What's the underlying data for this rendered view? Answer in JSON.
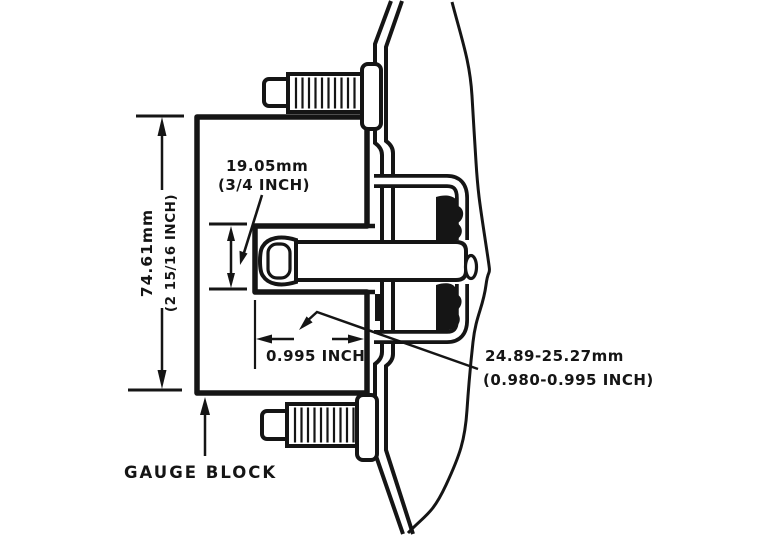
{
  "diagram": {
    "type": "technical-cross-section",
    "subject": "gauge block positioned against spindle and hub assembly",
    "colors": {
      "ink": "#151515",
      "background": "#ffffff"
    }
  },
  "dimensions": {
    "block_height_mm": "74.61mm",
    "block_height_in": "(2 15/16 INCH)",
    "notch_mm": "19.05mm",
    "notch_in": "(3/4 INCH)",
    "gap_in": "0.995 INCH",
    "bearing_mm": "24.89-25.27mm",
    "bearing_in": "(0.980-0.995 INCH)"
  },
  "labels": {
    "gauge_block": "GAUGE BLOCK"
  }
}
